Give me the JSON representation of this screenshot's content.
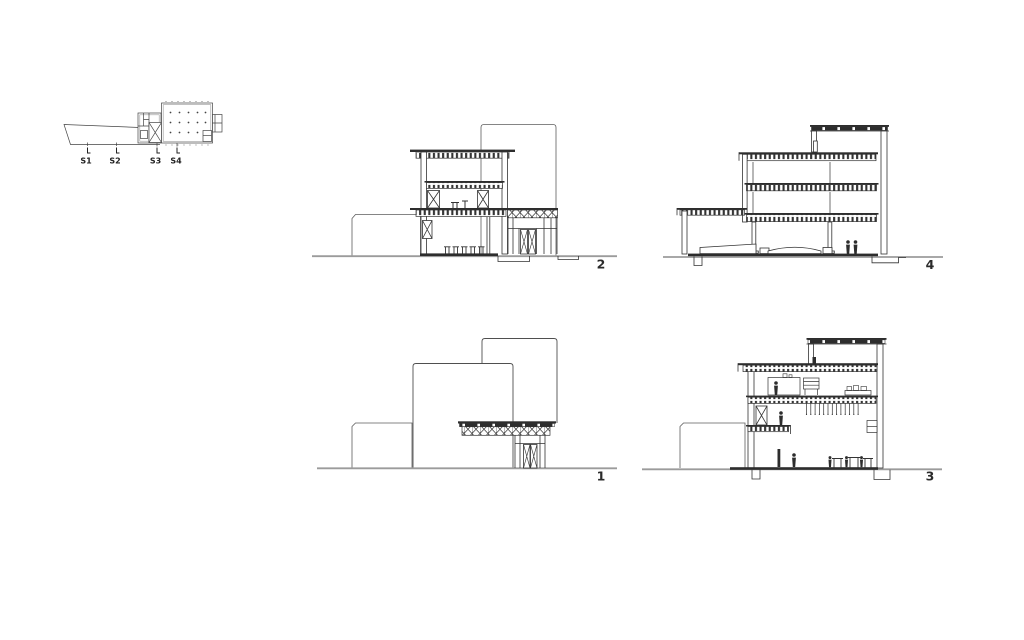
{
  "colors": {
    "background": "#ffffff",
    "line": "#333333",
    "light_line": "#5d5d5d",
    "ground_line": "#9b9b9b",
    "solid_fill": "#2d2d2d",
    "label_text": "#222222"
  },
  "key_plan": {
    "markers": [
      {
        "label": "S1"
      },
      {
        "label": "S2"
      },
      {
        "label": "S3"
      },
      {
        "label": "S4"
      }
    ]
  },
  "sections": [
    {
      "number": "2"
    },
    {
      "number": "4"
    },
    {
      "number": "1"
    },
    {
      "number": "3"
    }
  ]
}
